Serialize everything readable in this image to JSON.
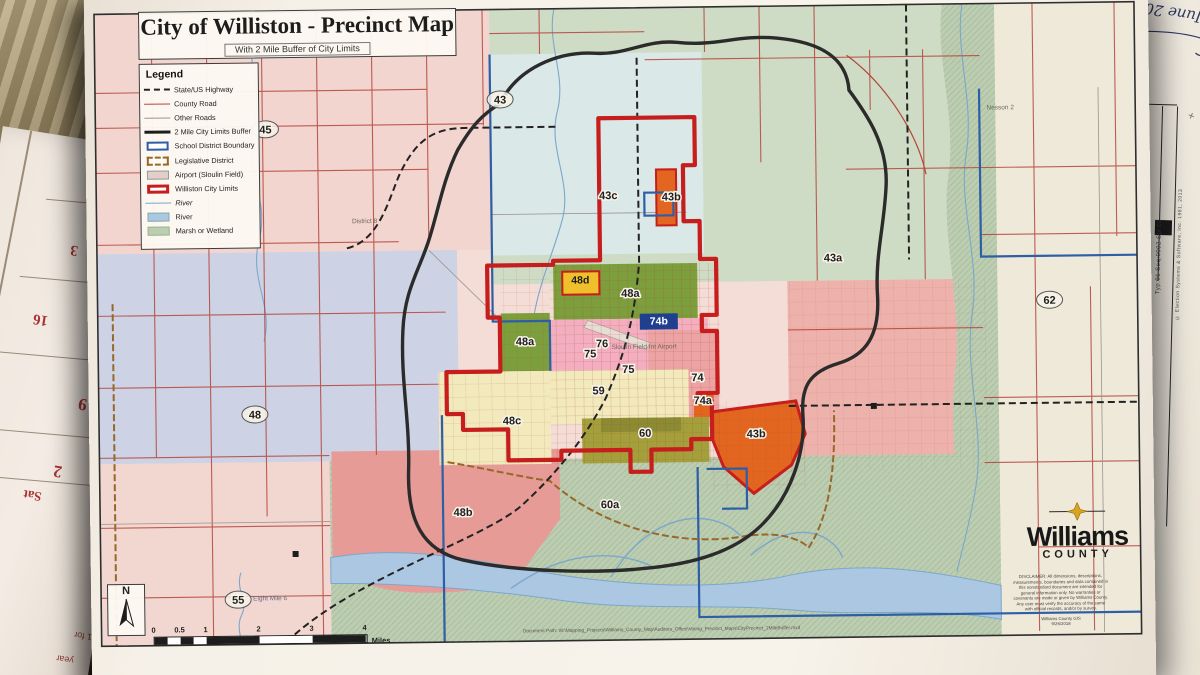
{
  "map": {
    "title": "City of Williston - Precinct Map",
    "subtitle": "With 2 Mile Buffer of City Limits",
    "legend": {
      "title": "Legend",
      "items": [
        {
          "label": "State/US Highway",
          "swatch": "dash-black"
        },
        {
          "label": "County Road",
          "swatch": "line-red"
        },
        {
          "label": "Other Roads",
          "swatch": "line-gray"
        },
        {
          "label": "2 Mile City Limits Buffer",
          "swatch": "line-thick-black"
        },
        {
          "label": "School District Boundary",
          "swatch": "box-blue"
        },
        {
          "label": "Legislative District",
          "swatch": "box-tan-dash"
        },
        {
          "label": "Airport (Sloulin Field)",
          "swatch": "box-pink"
        },
        {
          "label": "Williston City Limits",
          "swatch": "box-red"
        },
        {
          "label": "River",
          "swatch": "line-blue",
          "italic": true
        },
        {
          "label": "River",
          "swatch": "box-river"
        },
        {
          "label": "Marsh or Wetland",
          "swatch": "box-marsh"
        }
      ]
    },
    "precinct_labels": [
      {
        "id": "43",
        "text": "43",
        "x": 415,
        "y": 110,
        "kind": "ring"
      },
      {
        "id": "45",
        "text": "45",
        "x": 180,
        "y": 137,
        "kind": "ring"
      },
      {
        "id": "48",
        "text": "48",
        "x": 166,
        "y": 422,
        "kind": "ring"
      },
      {
        "id": "55",
        "text": "55",
        "x": 147,
        "y": 607,
        "kind": "ring"
      },
      {
        "id": "62",
        "text": "62",
        "x": 962,
        "y": 317,
        "kind": "ring"
      },
      {
        "id": "43c",
        "text": "43c",
        "x": 522,
        "y": 207,
        "kind": "halo"
      },
      {
        "id": "43b-top",
        "text": "43b",
        "x": 585,
        "y": 209,
        "kind": "halo"
      },
      {
        "id": "43a",
        "text": "43a",
        "x": 746,
        "y": 272,
        "kind": "halo"
      },
      {
        "id": "48d",
        "text": "48d",
        "x": 493,
        "y": 291,
        "kind": "yellow-box"
      },
      {
        "id": "48a-upper",
        "text": "48a",
        "x": 543,
        "y": 305,
        "kind": "halo"
      },
      {
        "id": "48a-west",
        "text": "48a",
        "x": 437,
        "y": 352,
        "kind": "halo"
      },
      {
        "id": "74b",
        "text": "74b",
        "x": 571,
        "y": 333,
        "kind": "blue-box"
      },
      {
        "id": "76",
        "text": "76",
        "x": 514,
        "y": 355,
        "kind": "halo"
      },
      {
        "id": "75-a",
        "text": "75",
        "x": 502,
        "y": 365,
        "kind": "halo"
      },
      {
        "id": "75-b",
        "text": "75",
        "x": 540,
        "y": 381,
        "kind": "halo"
      },
      {
        "id": "74",
        "text": "74",
        "x": 609,
        "y": 390,
        "kind": "halo"
      },
      {
        "id": "59",
        "text": "59",
        "x": 510,
        "y": 402,
        "kind": "halo"
      },
      {
        "id": "74a",
        "text": "74a",
        "x": 614,
        "y": 413,
        "kind": "halo"
      },
      {
        "id": "48c",
        "text": "48c",
        "x": 423,
        "y": 431,
        "kind": "halo"
      },
      {
        "id": "60",
        "text": "60",
        "x": 556,
        "y": 445,
        "kind": "halo"
      },
      {
        "id": "43b-east",
        "text": "43b",
        "x": 667,
        "y": 447,
        "kind": "halo"
      },
      {
        "id": "48b",
        "text": "48b",
        "x": 373,
        "y": 522,
        "kind": "halo"
      },
      {
        "id": "60a",
        "text": "60a",
        "x": 520,
        "y": 516,
        "kind": "halo"
      }
    ],
    "place_labels": [
      {
        "id": "nesson-2",
        "text": "Nesson 2",
        "x": 915,
        "y": 122,
        "kind": "place"
      },
      {
        "id": "district-8",
        "text": "District 8",
        "x": 278,
        "y": 228,
        "kind": "place"
      },
      {
        "id": "airport",
        "text": "Sloulin Field Int Airport",
        "x": 556,
        "y": 357,
        "kind": "place"
      },
      {
        "id": "eight-mile",
        "text": "Eight Mile 6",
        "x": 162,
        "y": 604,
        "kind": "road"
      }
    ],
    "north_label": "N",
    "scale": {
      "ticks": [
        "0",
        "0.5",
        "1",
        "2",
        "3",
        "4"
      ],
      "unit": "Miles"
    },
    "logo": {
      "name": "Williams",
      "sub": "COUNTY"
    },
    "disclaimer": "DISCLAIMER: All dimensions, descriptions, measurements, boundaries and data contained in this nonstandard document are intended for general information only. No warranties or covenants are made or given by Williams County. Any user must verify the accuracy of the same with official records, and/or by survey.",
    "credit": "Williams County GIS",
    "date": "9/26/2018",
    "document_path": "Document Path: W:\\Mapping_Projects\\Williams_County_Map\\Auditors_Office\\Voting_Precinct_Maps\\CityPrecinct_2MileBuffer.mxd"
  },
  "photo": {
    "handwritten_note": "June 2018",
    "ballot": {
      "line1": "Typ:01 Seq:0002 Spl:02",
      "line2": "© Election Systems & Software, Inc. 1981, 2013"
    },
    "calendar": {
      "numbers": [
        {
          "text": "3",
          "x": 86,
          "y": 102,
          "size": 15
        },
        {
          "text": "16",
          "x": 60,
          "y": 176,
          "size": 15
        },
        {
          "text": "9",
          "x": 118,
          "y": 252,
          "size": 17
        },
        {
          "text": "2",
          "x": 104,
          "y": 322,
          "size": 17
        },
        {
          "text": "Sat",
          "x": 78,
          "y": 352,
          "size": 13
        }
      ],
      "mini_month": "29 30 31\n22 23 24\n15 16 17\n8  9  10\n1  2  3\nSu Mo Tu",
      "foot1": "1 for",
      "foot2": "year"
    }
  },
  "colors": {
    "city_limits_red": "#c61d1d",
    "buffer_black": "#2b2b2b",
    "school_blue": "#2d5ea6",
    "legislative_brown": "#96682a",
    "river_blue": "#abc7e2",
    "marsh_green": "#bccdb2",
    "logo_gold": "#d9a520"
  }
}
